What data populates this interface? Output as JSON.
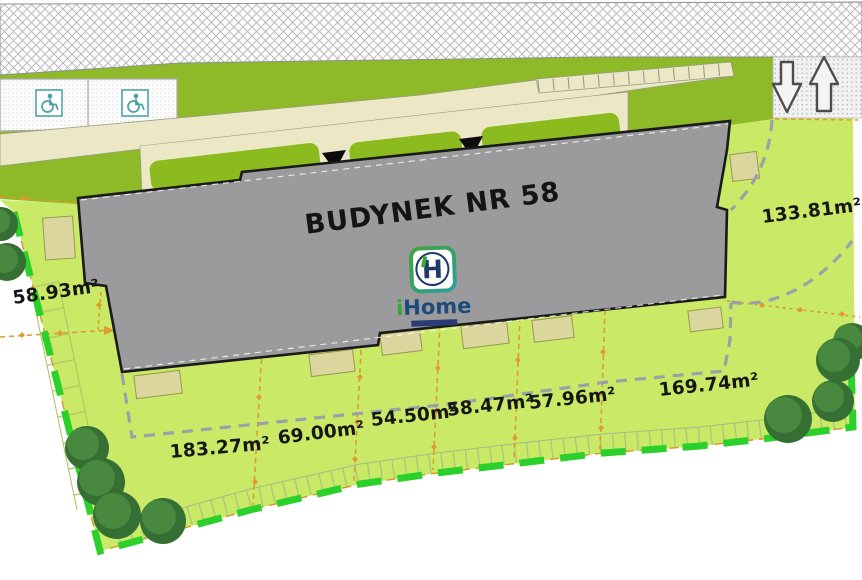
{
  "plan": {
    "building_label": "BUDYNEK NR 58",
    "logo": {
      "monogram": "H",
      "name_i": "i",
      "name_home": "Home"
    },
    "plot_areas": [
      "58.93m²",
      "133.81m²",
      "183.27m²",
      "69.00m²",
      "54.50m²",
      "58.47m²",
      "57.96m²",
      "169.74m²"
    ],
    "icons": {
      "accessible_parking": "wheelchair",
      "entrance_marker": "triangle-down",
      "traffic_out": "block-arrow-down",
      "traffic_in": "block-arrow-up",
      "trees": "tree-canopy"
    },
    "colors": {
      "lawn": "#c9e967",
      "green_strip": "#8eb929",
      "building_gray": "#9b9b9d",
      "path_tan": "#ece8c6",
      "boundary_green": "#2bd02b",
      "divider_orange": "#dd9c2d",
      "dash_gray": "#9aa1a8",
      "terrace_beige": "#dbd69e",
      "tree_green": "#356f33",
      "icon_teal": "#49a0a2",
      "logo_green": "#3aa63a",
      "logo_navy": "#1d4a7d"
    }
  }
}
